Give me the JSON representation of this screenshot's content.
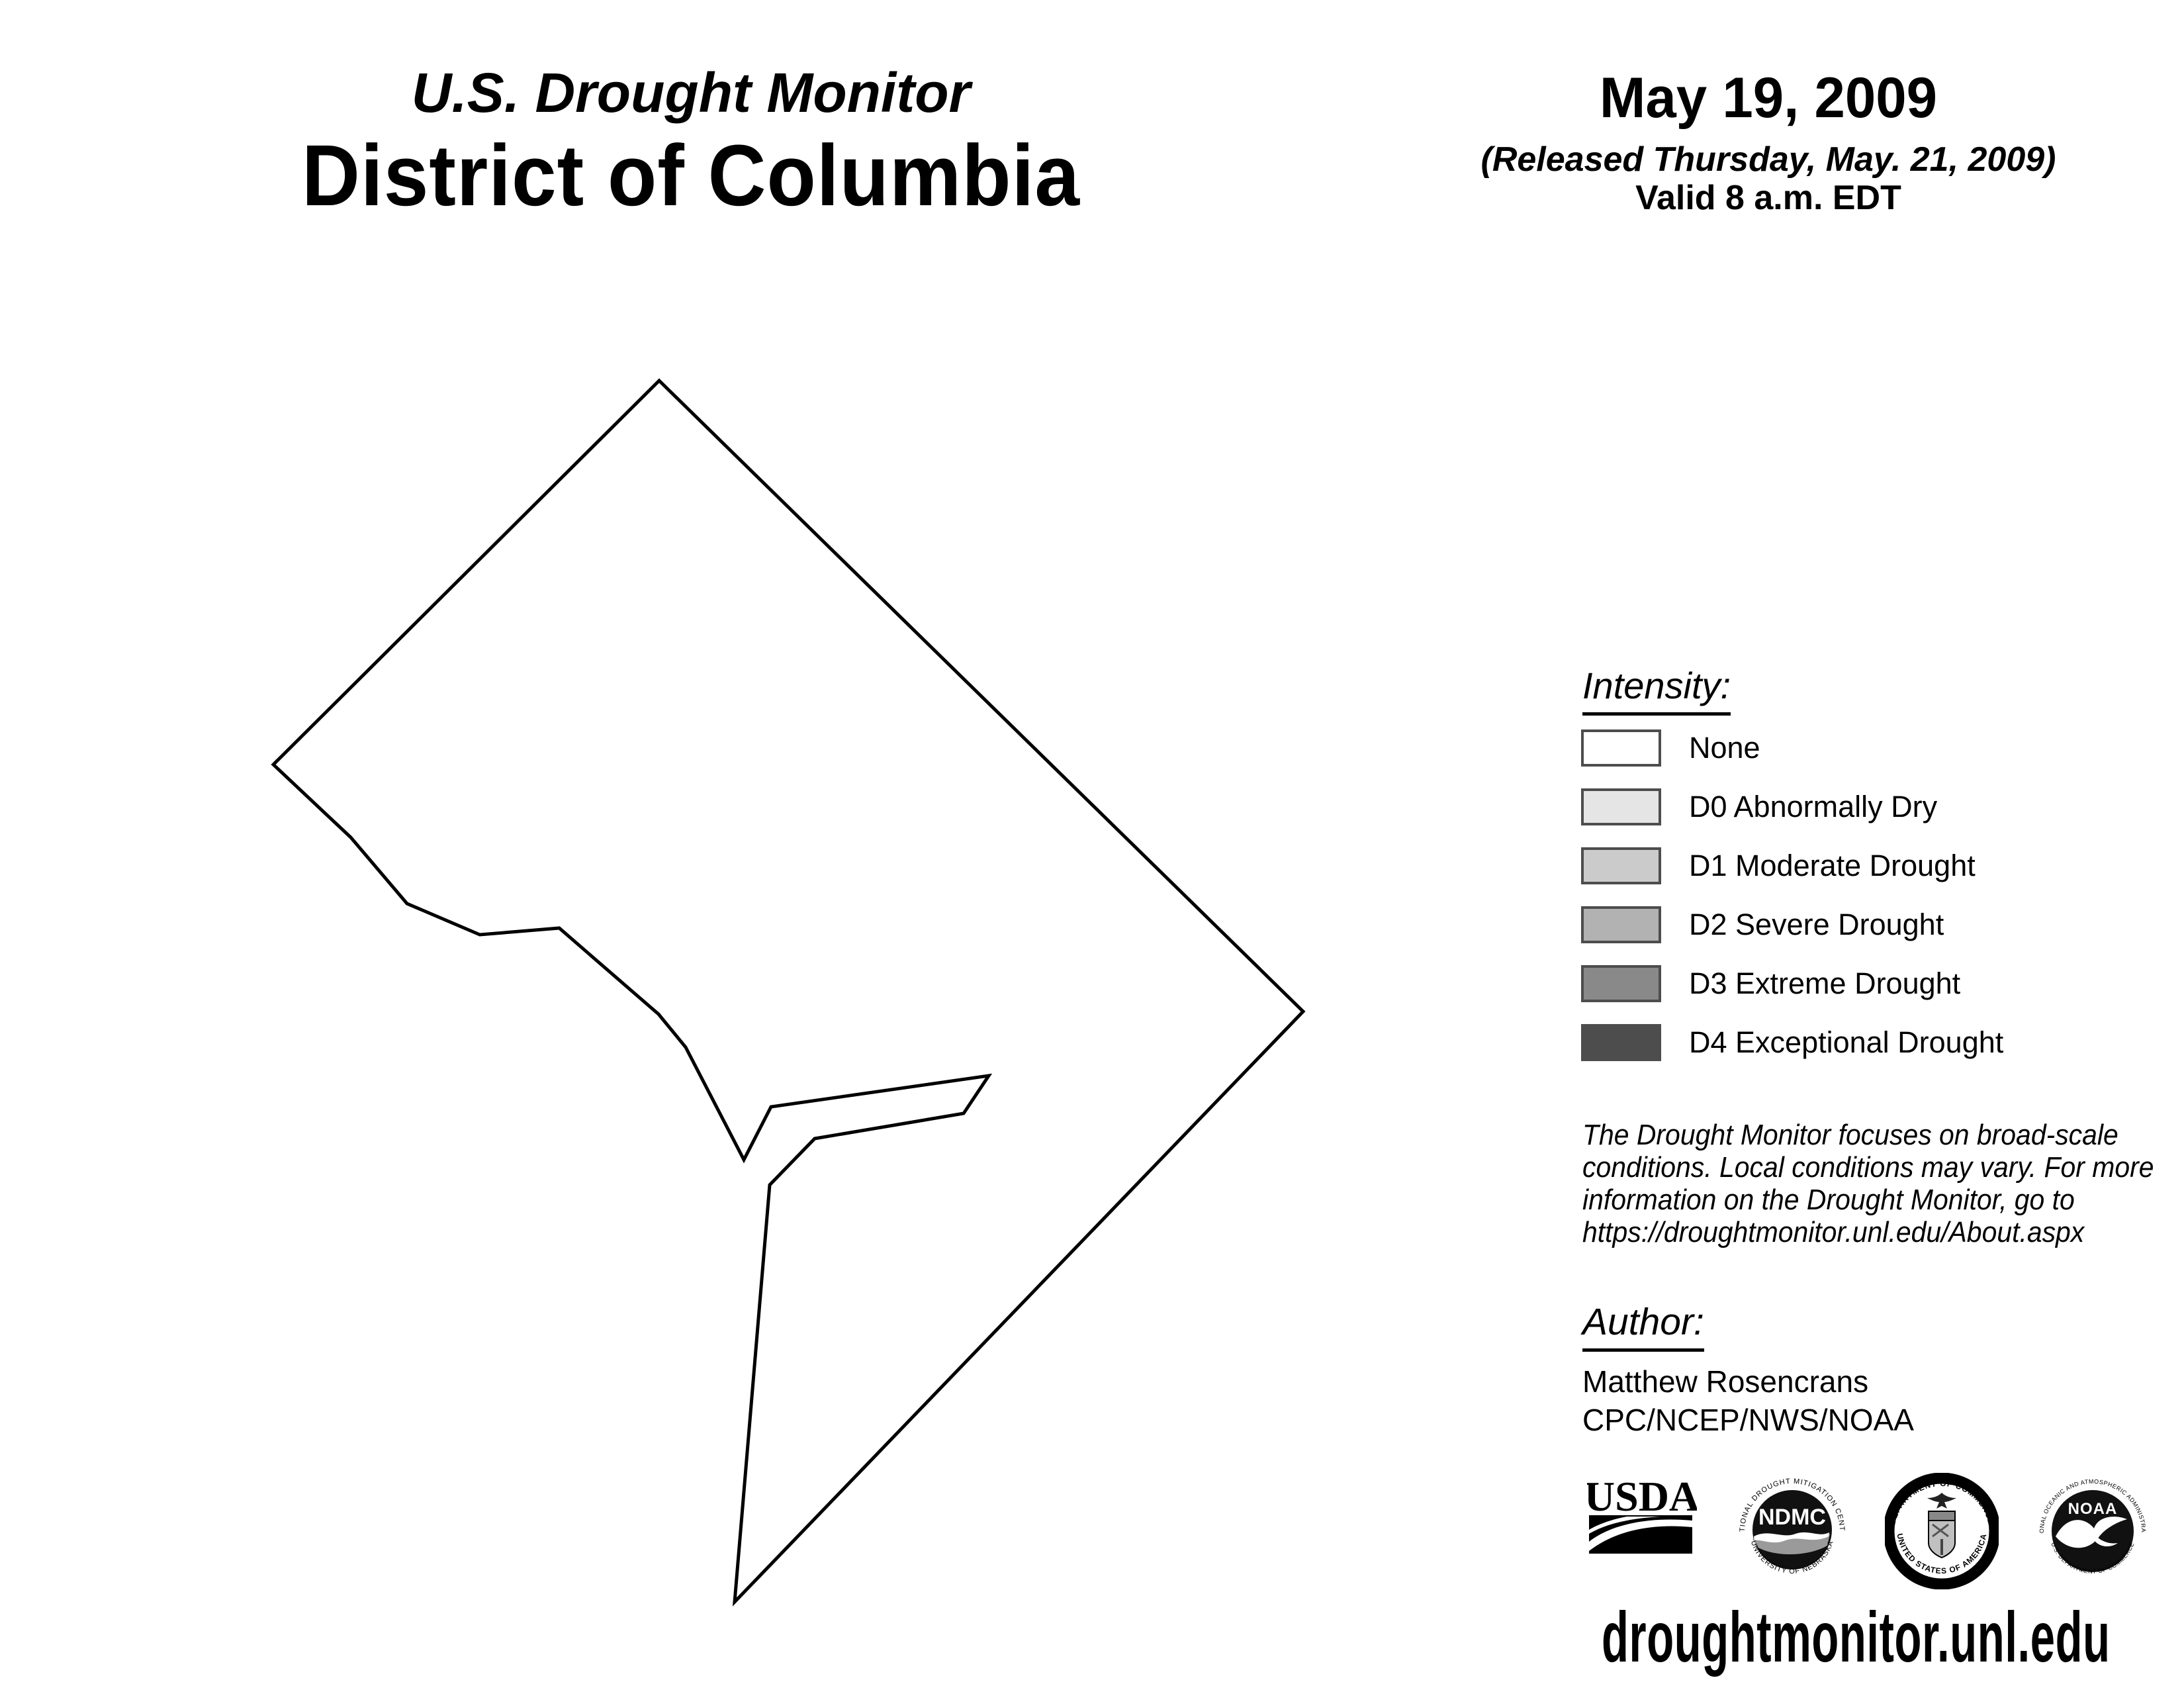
{
  "header": {
    "report_title": "U.S. Drought Monitor",
    "region_title": "District of Columbia",
    "map_date": "May 19, 2009",
    "released": "(Released Thursday, May. 21, 2009)",
    "valid": "Valid 8 a.m. EDT"
  },
  "legend": {
    "heading": "Intensity:",
    "swatch_border": "#4d4d4d",
    "items": [
      {
        "label": "None",
        "color": "#ffffff"
      },
      {
        "label": "D0 Abnormally Dry",
        "color": "#e5e5e5"
      },
      {
        "label": "D1 Moderate Drought",
        "color": "#cbcbcb"
      },
      {
        "label": "D2 Severe Drought",
        "color": "#b2b2b2"
      },
      {
        "label": "D3 Extreme Drought",
        "color": "#898989"
      },
      {
        "label": "D4 Exceptional Drought",
        "color": "#4d4d4d"
      }
    ]
  },
  "disclaimer": {
    "lines": [
      "The Drought Monitor focuses on broad-scale",
      "conditions. Local conditions may vary. For more",
      "information on the Drought Monitor, go to",
      "https://droughtmonitor.unl.edu/About.aspx"
    ]
  },
  "author": {
    "heading": "Author:",
    "name": "Matthew Rosencrans",
    "organization": "CPC/NCEP/NWS/NOAA"
  },
  "footer": {
    "url": "droughtmonitor.unl.edu"
  },
  "logos": {
    "usda": {
      "text": "USDA"
    },
    "ndmc": {
      "text": "NDMC",
      "ring_top": "NATIONAL DROUGHT MITIGATION CENTER",
      "ring_bottom": "UNIVERSITY OF NEBRASKA"
    },
    "commerce": {
      "ring_top": "DEPARTMENT OF COMMERCE",
      "ring_bottom": "UNITED STATES OF AMERICA"
    },
    "noaa": {
      "text": "NOAA",
      "ring_top": "NATIONAL OCEANIC AND ATMOSPHERIC ADMINISTRATION",
      "ring_bottom": "U.S. DEPARTMENT OF COMMERCE"
    }
  },
  "map": {
    "region": "District of Columbia",
    "drought_status": "None",
    "fill": "#ffffff",
    "outline_color": "#000000",
    "outline_points": "996,575 413,1155 530,1265 615,1365 725,1412 845,1402 995,1532 1036,1582 1124,1752 1165,1672 1494,1625 1456,1682 1231,1720 1163,1790 1110,2420 1969,1528"
  }
}
